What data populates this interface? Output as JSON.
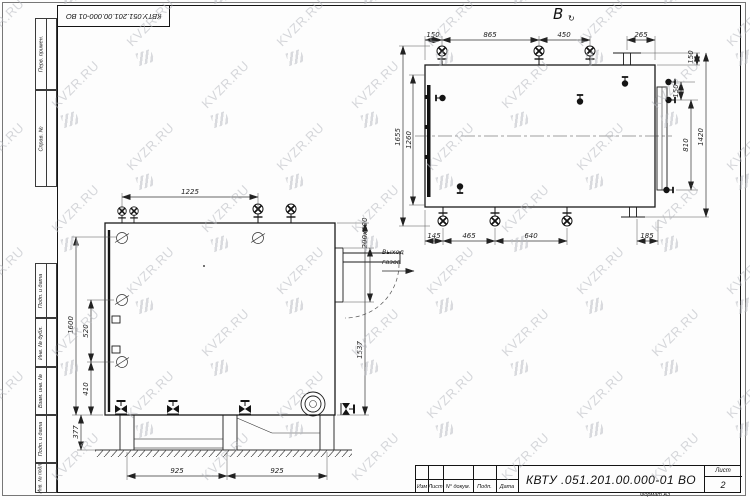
{
  "watermark": {
    "text": "KVZR.RU"
  },
  "frame": {
    "stamp_top_left": "КВТУ.051.201.00.000-01 ВО",
    "margin_upper": [
      "Перв. примен.",
      "Справ. №"
    ],
    "margin_lower": [
      "Подп. и дата",
      "Инв. № дубл.",
      "Взам. инв. №",
      "Подп. и дата",
      "Инв. № подл."
    ]
  },
  "title_block": {
    "designation": "КВТУ .051.201.00.000-01  ВО",
    "cols": [
      "Изм",
      "Лист",
      "N° докум.",
      "Подп.",
      "Дата"
    ],
    "sheet_label": "Лист",
    "sheet_number": "2",
    "format": "Формат   А3"
  },
  "top_view": {
    "label": "В",
    "rot_mark": "↻",
    "dims": {
      "top": [
        "150",
        "865",
        "450"
      ],
      "top_right": "265",
      "right_top": "150",
      "right": [
        "150",
        "810",
        "1420"
      ],
      "left": [
        "1655",
        "1260"
      ],
      "bottom": [
        "145",
        "465",
        "640",
        "185"
      ]
    }
  },
  "front_view": {
    "dims": {
      "top": "1225",
      "left": [
        "1600",
        "520",
        "410",
        "377"
      ],
      "right": "1537",
      "outlet": "200х600",
      "bottom": [
        "925",
        "925"
      ]
    },
    "outlet_label": [
      "Выход",
      "газов"
    ]
  }
}
